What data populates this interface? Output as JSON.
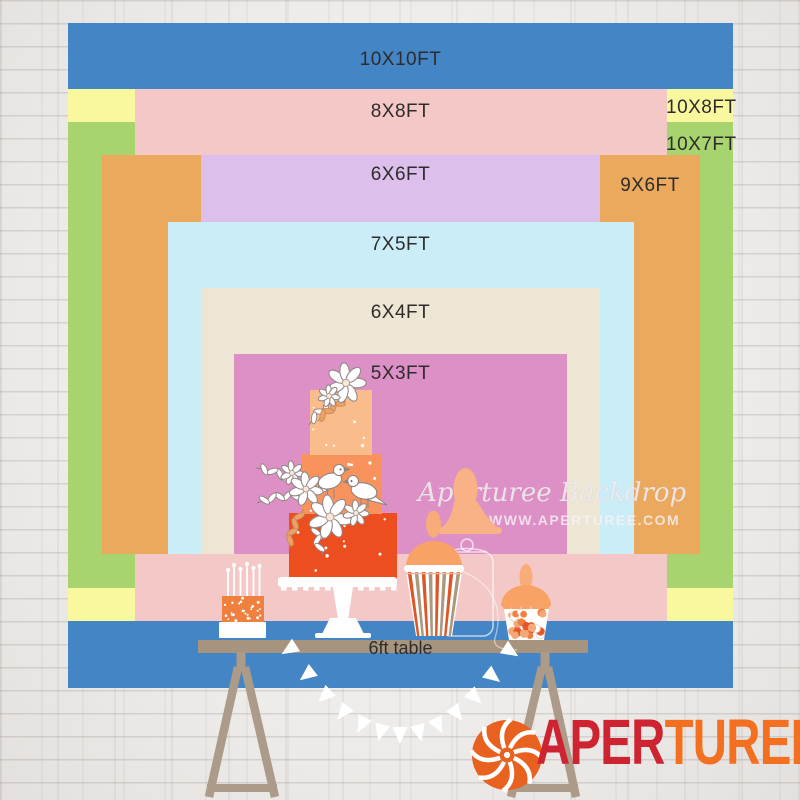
{
  "size_chart": {
    "ft10x10": "10X10FT",
    "ft8x8": "8X8FT",
    "ft10x8": "10X8FT",
    "ft10x7": "10X7FT",
    "ft6x6": "6X6FT",
    "ft9x6": "9X6FT",
    "ft7x5": "7X5FT",
    "ft6x4": "6X4FT",
    "ft5x3": "5X3FT"
  },
  "table": {
    "label": "6ft table"
  },
  "watermark": {
    "brand_script": "Aperturee Backdrop",
    "website": "WWW.APERTUREE.COM"
  },
  "logo": {
    "icon": "aperture-icon",
    "word_part1": "APER",
    "word_part2": "TUREE"
  },
  "colors": {
    "size_10x10_blue": "#4485C5",
    "size_10x8_yellow": "#FAF89E",
    "size_10x7_green": "#A7D46E",
    "size_8x8_pink": "#F4C8C6",
    "size_9x6_orange": "#EBA95D",
    "size_6x6_lavender": "#DCC0EB",
    "size_7x5_lightblue": "#CBEDF8",
    "size_6x4_cream": "#EDE6D4",
    "size_5x3_magenta": "#DD90C5",
    "table_wood": "#A6947E",
    "trestle_wood": "#AC9B88",
    "cake_tier_top": "#FBBC8C",
    "cake_tier_middle": "#F9935E",
    "cake_tier_bottom": "#EC4E20",
    "mini_cake_orange": "#F08040",
    "candy_orange": "#E4572B",
    "candy_peach": "#F4A876",
    "stripe_orange": "#DE5628",
    "stripe_tan": "#A9997F",
    "silhouette_peach": "#F8B285",
    "logo_red": "#CE2330",
    "logo_orange": "#F2701F",
    "logo_icon_orange": "#E9611F",
    "wall_white": "#EFEDEB"
  }
}
